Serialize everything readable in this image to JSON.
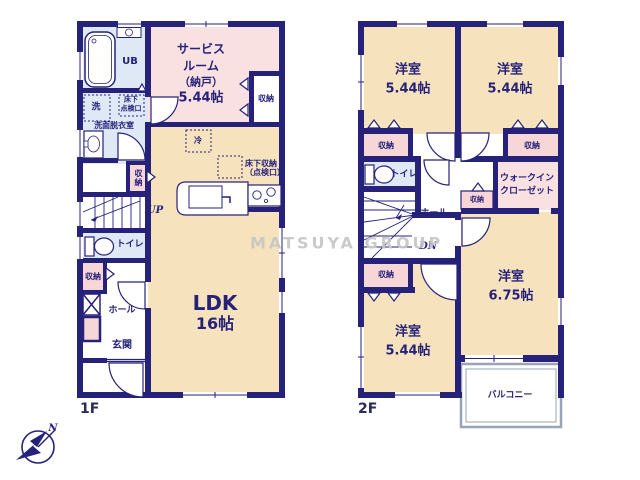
{
  "watermark": "MATSUYA GROUP",
  "compass": {
    "north": "N"
  },
  "colors": {
    "wall_navy": "#26227a",
    "room_cream": "#f6e3bd",
    "room_pink": "#f9e0e1",
    "closet_pink": "#f7d6d8",
    "wet_blue": "#dfe9f5",
    "balcony_gray": "#9ba3b8",
    "watermark_gray": "#c5c5c5"
  },
  "floor1": {
    "floor_label": "1F",
    "unit_bath": "UB",
    "service_room": {
      "name_1": "サービス",
      "name_2": "ルーム",
      "name_3": "（納戸）",
      "size": "5.44帖"
    },
    "service_closet": "収納",
    "laundry": "洗",
    "underfloor_access": {
      "line1": "床下",
      "line2": "点検口"
    },
    "washroom": "洗面脱衣室",
    "hall_closet": "収納",
    "stairs_up": "UP",
    "toilet": "トイレ",
    "entry_closet": "収納",
    "hall": "ホール",
    "entrance": "玄関",
    "ldk": {
      "name": "LDK",
      "size": "16帖"
    },
    "fridge": "冷",
    "underfloor_storage": {
      "line1": "床下収納",
      "line2": "（点検口）"
    }
  },
  "floor2": {
    "floor_label": "2F",
    "bedroom_nw": {
      "name": "洋室",
      "size": "5.44帖"
    },
    "bedroom_ne": {
      "name": "洋室",
      "size": "5.44帖"
    },
    "bedroom_sw": {
      "name": "洋室",
      "size": "5.44帖"
    },
    "bedroom_se": {
      "name": "洋室",
      "size": "6.75帖"
    },
    "closet_nw": "収納",
    "closet_ne": "収納",
    "closet_mid": "収納",
    "closet_sw": "収納",
    "walk_in_closet": {
      "line1": "ウォークイン",
      "line2": "クローゼット"
    },
    "toilet": "トイレ",
    "hall": "ホール",
    "stairs_down": "DN",
    "balcony": "バルコニー"
  }
}
